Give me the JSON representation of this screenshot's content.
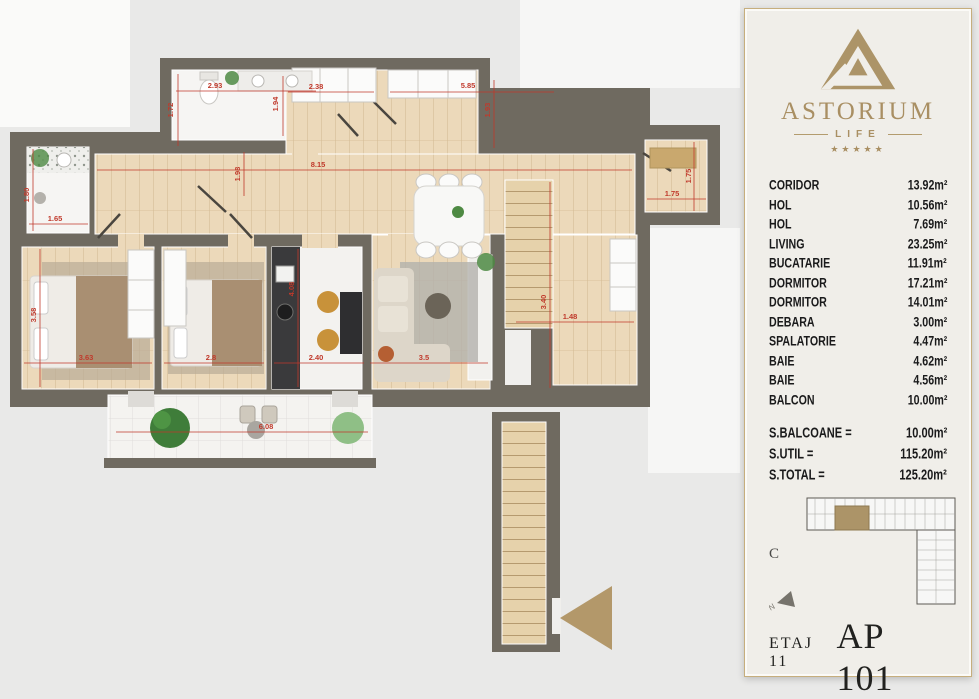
{
  "panel": {
    "brand": {
      "name": "ASTORIUM",
      "subtitle": "LIFE",
      "stars": "★★★★★"
    },
    "rooms": [
      {
        "name": "CORIDOR",
        "area": "13.92m²"
      },
      {
        "name": "HOL",
        "area": "10.56m²"
      },
      {
        "name": "HOL",
        "area": "7.69m²"
      },
      {
        "name": "LIVING",
        "area": "23.25m²"
      },
      {
        "name": "BUCATARIE",
        "area": "11.91m²"
      },
      {
        "name": "DORMITOR",
        "area": "17.21m²"
      },
      {
        "name": "DORMITOR",
        "area": "14.01m²"
      },
      {
        "name": "DEBARA",
        "area": "3.00m²"
      },
      {
        "name": "SPALATORIE",
        "area": "4.47m²"
      },
      {
        "name": "BAIE",
        "area": "4.62m²"
      },
      {
        "name": "BAIE",
        "area": "4.56m²"
      },
      {
        "name": "BALCON",
        "area": "10.00m²"
      }
    ],
    "totals": [
      {
        "label": "S.BALCOANE =",
        "value": "10.00m²"
      },
      {
        "label": "S.UTIL =",
        "value": "115.20m²"
      },
      {
        "label": "S.TOTAL =",
        "value": "125.20m²"
      }
    ],
    "keyplan": {
      "section_label": "C",
      "compass_label": "N"
    },
    "floor_label": "ETAJ 11",
    "apartment_label": "AP 101"
  },
  "plan": {
    "dimensions": [
      {
        "label": "2.93"
      },
      {
        "label": "1.72"
      },
      {
        "label": "2.38"
      },
      {
        "label": "1.94"
      },
      {
        "label": "5.85"
      },
      {
        "label": "1.93"
      },
      {
        "label": "8.15"
      },
      {
        "label": "1.98"
      },
      {
        "label": "1.65"
      },
      {
        "label": "1.80"
      },
      {
        "label": "3.63"
      },
      {
        "label": "3.58"
      },
      {
        "label": "2.8"
      },
      {
        "label": "4.08"
      },
      {
        "label": "2.40"
      },
      {
        "label": "3.5"
      },
      {
        "label": "3.40"
      },
      {
        "label": "1.48"
      },
      {
        "label": "1.75"
      },
      {
        "label": "1.75"
      },
      {
        "label": "6.08"
      }
    ]
  },
  "colors": {
    "gold": "#ac9468",
    "wall": "#6f6a60",
    "dimension_red": "#c0392b",
    "wood": "#ecd9ba",
    "card_bg": "#f0eee9"
  }
}
